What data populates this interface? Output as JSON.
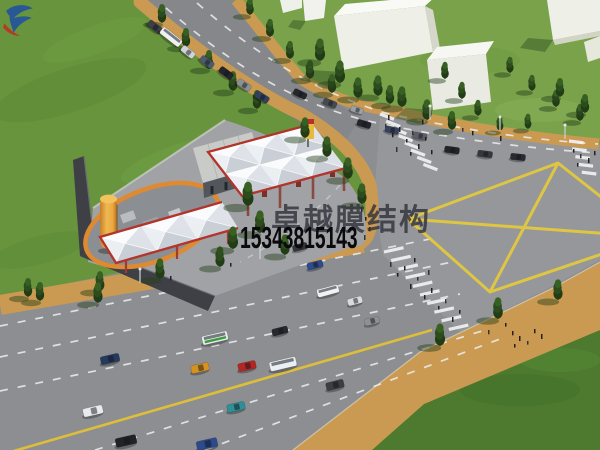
{
  "scene": {
    "type": "3d-architectural-rendering",
    "description": "Aerial rendering of a gas station with white membrane-structure canopies beside a large road intersection with a yellow box-junction marking, tree-lined boulevards, crosswalks with pedestrians, traffic, lawns and white block buildings"
  },
  "watermark": {
    "logo_icon": "swoosh-logo",
    "brand": "卓越膜结构",
    "phone": "15343815143",
    "brand_color": "rgba(50,50,58,0.82)",
    "phone_color": "#0a0a0c",
    "logo_blue": "#1d4ea6",
    "logo_red": "#c22a22"
  },
  "palette": {
    "grass": "#67943c",
    "lawn_light": "#79a24a",
    "grass_dark": "#4d7a2f",
    "asphalt": "#8c8e91",
    "asphalt_dark": "#7d8084",
    "intersection_light": "#9b9da1",
    "sidewalk_tan": "#cb9a52",
    "lane_yellow": "#dcbe3c",
    "marking_white": "#f2f3f5",
    "canopy_white": "#f1f2f4",
    "canopy_trim_red": "#b2342b",
    "station_platform": "#a0a2a6",
    "wall_dark": "#3e4045",
    "tank_orange": "#eaa83e",
    "building_white": "#eef0e8",
    "tree_green": "#2c4c1e"
  }
}
